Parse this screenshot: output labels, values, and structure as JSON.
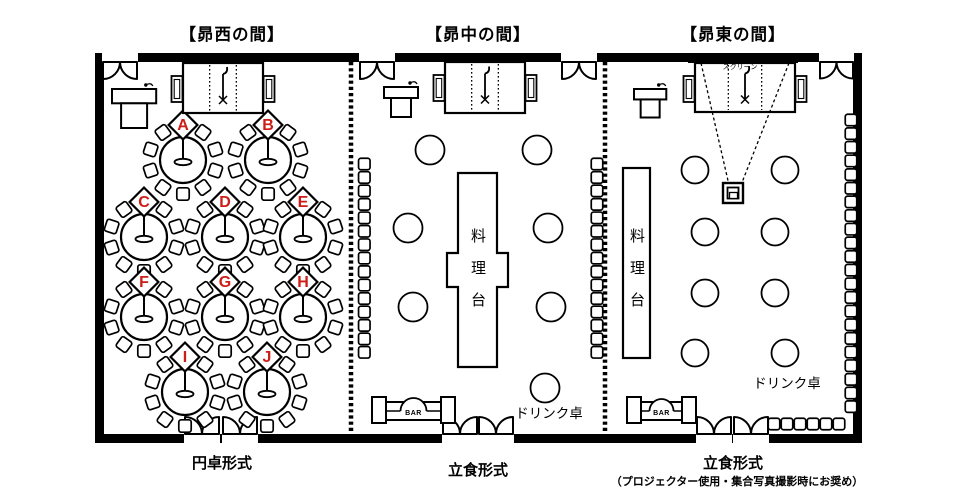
{
  "diagram": {
    "colors": {
      "line": "#000000",
      "table_letter": "#cc1d17",
      "background": "#ffffff"
    },
    "rooms": [
      {
        "title": "【昴西の間】",
        "format_label": "円卓形式",
        "table_labels": [
          "A",
          "B",
          "C",
          "D",
          "E",
          "F",
          "G",
          "H",
          "I",
          "J"
        ]
      },
      {
        "title": "【昴中の間】",
        "format_label": "立食形式",
        "food_station_label": "料理台",
        "drink_table_label": "ドリンク卓",
        "bar_label": "BAR"
      },
      {
        "title": "【昴東の間】",
        "format_label": "立食形式",
        "format_note": "（プロジェクター使用・集合写真撮影時にお奨め）",
        "food_station_label": "料理台",
        "drink_table_label": "ドリンク卓",
        "bar_label": "BAR",
        "screen_label": "スクリーン"
      }
    ]
  }
}
